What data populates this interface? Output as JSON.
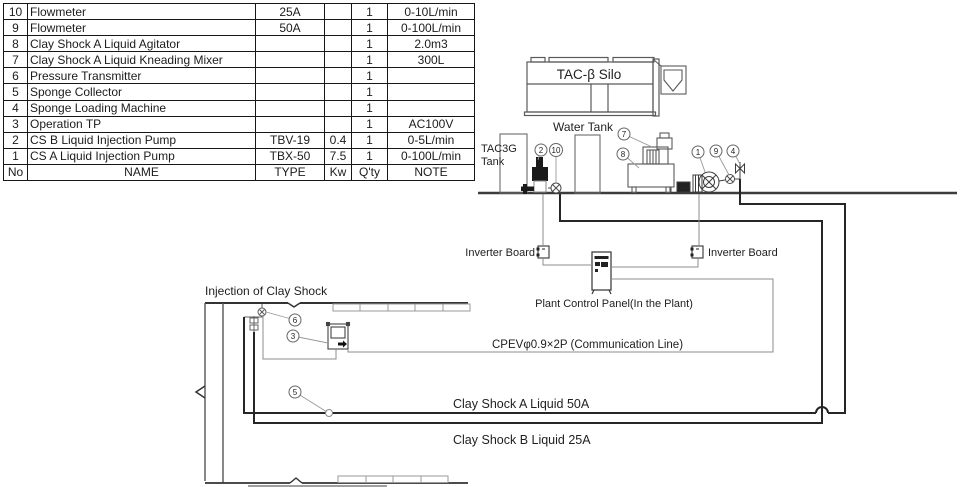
{
  "table": {
    "header": [
      "No",
      "NAME",
      "TYPE",
      "Kw",
      "Q'ty",
      "NOTE"
    ],
    "rows": [
      {
        "no": "10",
        "name": "Flowmeter",
        "type": "25A",
        "kw": "",
        "qty": "1",
        "note": "0-10L/min"
      },
      {
        "no": "9",
        "name": "Flowmeter",
        "type": "50A",
        "kw": "",
        "qty": "1",
        "note": "0-100L/min"
      },
      {
        "no": "8",
        "name": "Clay Shock A Liquid Agitator",
        "type": "",
        "kw": "",
        "qty": "1",
        "note": "2.0m3"
      },
      {
        "no": "7",
        "name": "Clay Shock A Liquid Kneading Mixer",
        "type": "",
        "kw": "",
        "qty": "1",
        "note": "300L"
      },
      {
        "no": "6",
        "name": "Pressure Transmitter",
        "type": "",
        "kw": "",
        "qty": "1",
        "note": ""
      },
      {
        "no": "5",
        "name": "Sponge Collector",
        "type": "",
        "kw": "",
        "qty": "1",
        "note": ""
      },
      {
        "no": "4",
        "name": "Sponge Loading Machine",
        "type": "",
        "kw": "",
        "qty": "1",
        "note": ""
      },
      {
        "no": "3",
        "name": "Operation TP",
        "type": "",
        "kw": "",
        "qty": "1",
        "note": "AC100V"
      },
      {
        "no": "2",
        "name": "CS B Liquid Injection Pump",
        "type": "TBV-19",
        "kw": "0.4",
        "qty": "1",
        "note": "0-5L/min"
      },
      {
        "no": "1",
        "name": "CS A Liquid Injection Pump",
        "type": "TBX-50",
        "kw": "7.5",
        "qty": "1",
        "note": "0-100L/min"
      }
    ]
  },
  "diagram": {
    "silo_label": "TAC-β Silo",
    "water_tank_label": "Water Tank",
    "tac3g_label_1": "TAC3G",
    "tac3g_label_2": "Tank",
    "inverter_left_label": "Inverter Board",
    "inverter_right_label": "Inverter Board",
    "plant_panel_label": "Plant Control Panel(In the Plant)",
    "comm_line_label": "CPEVφ0.9×2P (Communication Line)",
    "injection_label": "Injection of Clay Shock",
    "liquid_a_label": "Clay Shock A Liquid 50A",
    "liquid_b_label": "Clay Shock B Liquid 25A",
    "callouts": {
      "c1": "1",
      "c2": "2",
      "c3": "3",
      "c4": "4",
      "c5": "5",
      "c6": "6",
      "c7": "7",
      "c8": "8",
      "c9": "9",
      "c10": "10"
    }
  }
}
